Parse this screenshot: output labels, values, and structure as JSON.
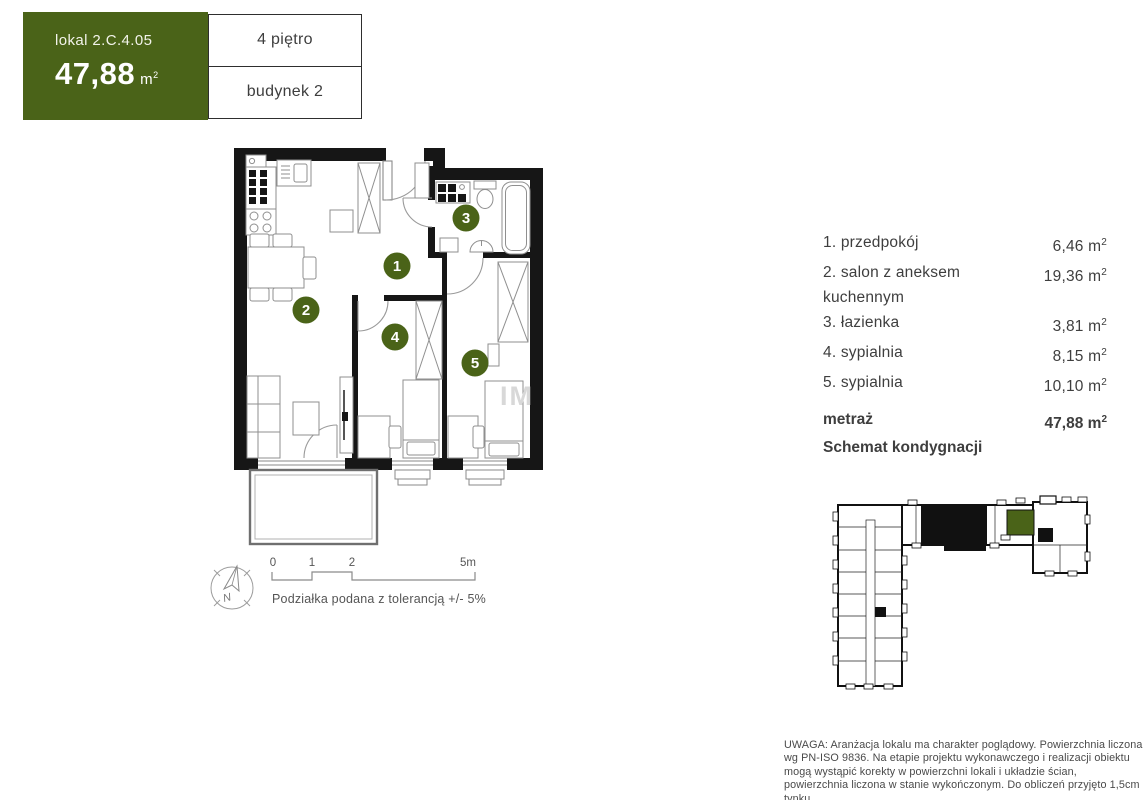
{
  "header": {
    "unit_label": "lokal 2.C.4.05",
    "area_value": "47,88",
    "unit_m": "m",
    "unit_sup": "2",
    "floor": "4 piętro",
    "building": "budynek 2"
  },
  "room_list": {
    "rows": [
      {
        "label": "1. przedpokój",
        "area": "6,46"
      },
      {
        "label": "2. salon z aneksem kuchennym",
        "area": "19,36"
      },
      {
        "label": "3. łazienka",
        "area": "3,81"
      },
      {
        "label": "4. sypialnia",
        "area": "8,15"
      },
      {
        "label": "5. sypialnia",
        "area": "10,10"
      }
    ],
    "unit_m": "m",
    "unit_sup": "2"
  },
  "summary": {
    "metraz_label": "metraż",
    "metraz_value": "47,88",
    "unit_m": "m",
    "unit_sup": "2",
    "schemat_label": "Schemat kondygnacji"
  },
  "plan": {
    "labels": [
      "1",
      "2",
      "3",
      "4",
      "5"
    ],
    "watermark": "IM"
  },
  "scalebar": {
    "t0": "0",
    "t1": "1",
    "t2": "2",
    "t5": "5m",
    "note": "Podziałka podana z tolerancją +/- 5%"
  },
  "compass": {
    "north": "N"
  },
  "disclaimer": "UWAGA: Aranżacja lokalu ma charakter poglądowy. Powierzchnia liczona wg PN-ISO 9836. Na etapie projektu wykonawczego i realizacji obiektu mogą wystąpić korekty w powierzchni lokali i układzie ścian, powierzchnia liczona w stanie wykończonym. Do obliczeń przyjęto 1,5cm tynku.",
  "colors": {
    "accent_green": "#4a6318",
    "wall_black": "#161616",
    "furniture_line": "#8f8f8f",
    "text": "#3e3e3e"
  }
}
